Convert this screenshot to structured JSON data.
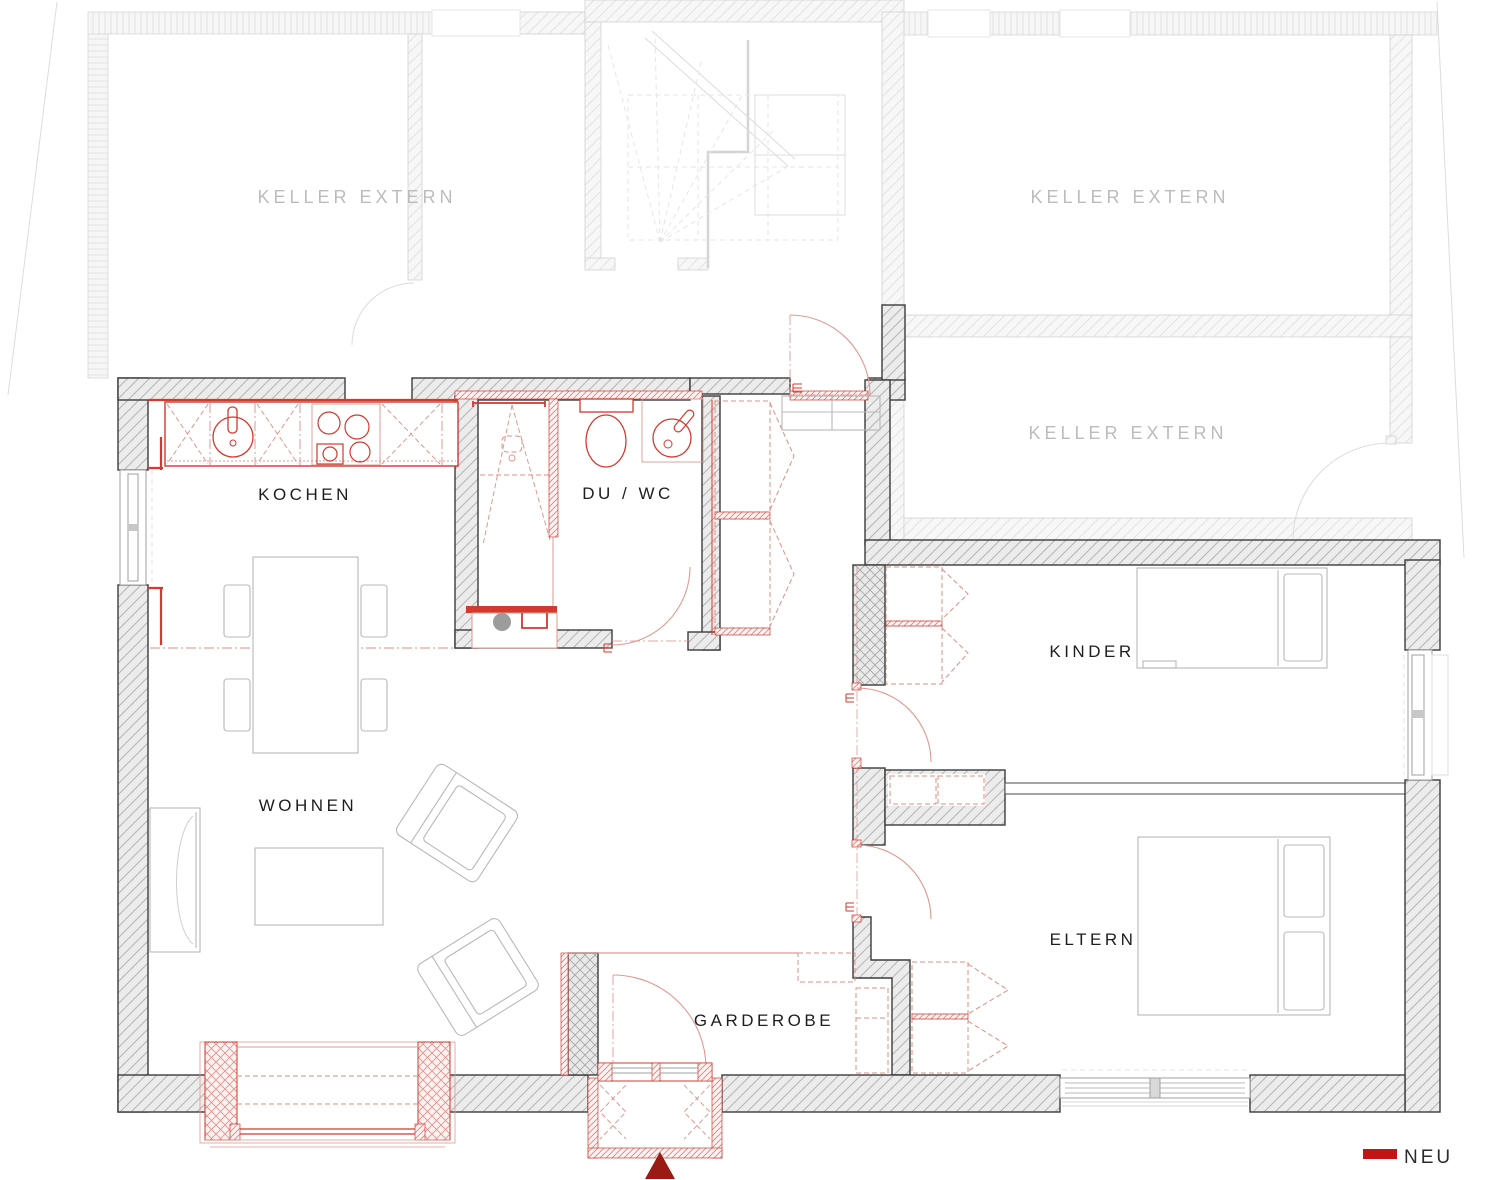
{
  "plan": {
    "labels": {
      "keller_top_left": "KELLER EXTERN",
      "keller_top_right": "KELLER EXTERN",
      "keller_mid_right": "KELLER EXTERN",
      "kochen": "KOCHEN",
      "du_wc": "DU / WC",
      "kinder": "KINDER",
      "wohnen": "WOHNEN",
      "eltern": "ELTERN",
      "garderobe": "GARDEROBE"
    },
    "legend": {
      "label": "NEU",
      "swatch_color": "#c41414"
    },
    "markers": {
      "entrance_color": "#9a1a14"
    },
    "colors": {
      "new_red": "#d3392e",
      "light_red": "#e09992",
      "wall_outline": "#3c3c3c",
      "wall_hatch": "#b4b4b4",
      "faint_gray": "#dadada",
      "label_dark": "#1d1d1d",
      "label_faint": "#bcbcbc"
    }
  }
}
